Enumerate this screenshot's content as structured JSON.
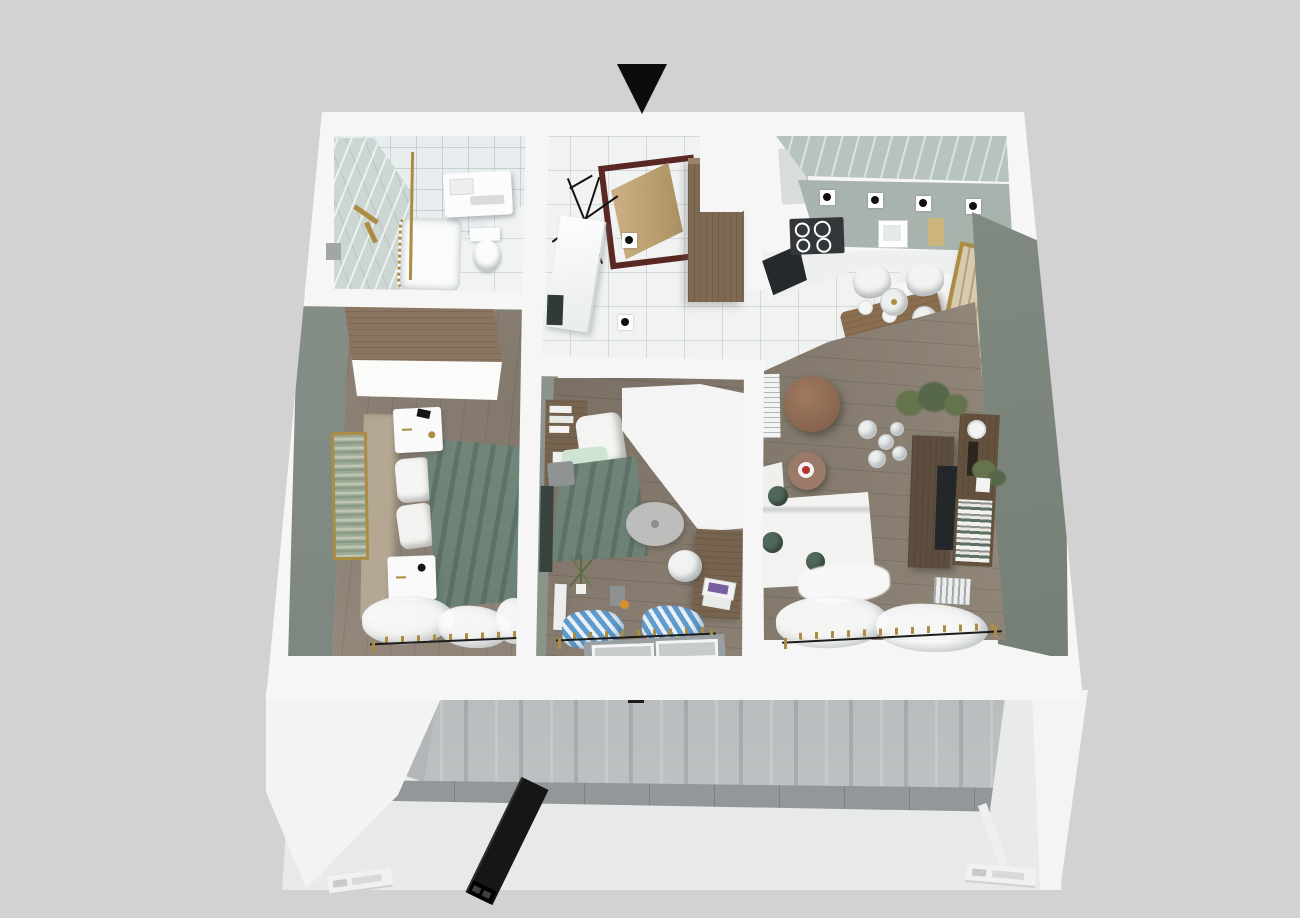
{
  "scene": {
    "kind": "3d-apartment-floorplan-render",
    "view": "top-down cutaway with building facade below",
    "width_px": 1300,
    "height_px": 918
  },
  "marker": {
    "shape": "triangle-down",
    "meaning": "entrance-direction-marker",
    "color": "#0c0c0c"
  },
  "colors": {
    "bg": "#d2d2d2",
    "wallWhite": "#f6f6f6",
    "wallShade": "#e2e4e4",
    "tileWhite": "#f1f3f3",
    "bathGrid": "#e8eeef",
    "marble": "#ccd6d3",
    "kitchenMarble": "#b7c4be",
    "cabinetSage": "#a9b3ad",
    "sage": "#8b948b",
    "sageDark": "#75807a",
    "greenWall": "#7d877d",
    "bed1Floor": "#9c9183",
    "bed2Floor": "#8d8174",
    "livingFloor": "#968c7e",
    "wardrobeWood": "#8b7560",
    "hallWood": "#7e6a53",
    "deskWood": "#77644f",
    "tvWood": "#5d4d3e",
    "tableWood": "#8a6e50",
    "doorWood": "#c3a878",
    "doorFrame": "#5a2823",
    "blanketGreen": "#5c7567",
    "cushionGreen": "#50685a",
    "plantGreen": "#66744d",
    "gold": "#ab8c42",
    "rodBlack": "#1c1c1c",
    "curtainBlue": "#5f9bcd",
    "rugBrown": "#9b7a6a",
    "rugGray": "#c2c4c3",
    "artBeige": "#d8caaf",
    "stoveDark": "#33373a",
    "tvDark": "#24272a",
    "concreteDark": "#9aa0a3",
    "concreteLight": "#c2c6c7",
    "facadeLight": "#e8e9e9",
    "ledgeGray": "#caced0",
    "accentOrange": "#d98f2e",
    "cakeRed": "#b5342c"
  },
  "apartment": {
    "rooms": [
      {
        "name": "bathroom",
        "position": "top-left",
        "furniture": [
          "marble-shower-wall",
          "gold-shower-fixture",
          "gold-shower-rail",
          "bathtub",
          "floating-washbasin",
          "toilet",
          "tiled-ceiling-grid"
        ]
      },
      {
        "name": "entry-hall",
        "position": "top-center",
        "furniture": [
          "entry-door-open",
          "dark-red-door-frame",
          "coat-rack",
          "leaning-mirror",
          "hall-wardrobe",
          "ceiling-spotlights",
          "white-tile-floor"
        ]
      },
      {
        "name": "kitchen-dining",
        "position": "top-right",
        "furniture": [
          "upper-cabinets-with-spotlights",
          "induction-stove",
          "oven",
          "sink",
          "counter",
          "fridge",
          "dining-table",
          "four-white-chairs",
          "pendant-lamps",
          "gold-framed-art"
        ]
      },
      {
        "name": "bedroom-primary",
        "position": "left",
        "furniture": [
          "wood-wardrobe",
          "double-bed",
          "green-blanket",
          "white-pillows",
          "nightstand-top",
          "nightstand-bottom",
          "tall-wall-art",
          "sheer-curtains",
          "curtain-rod-gold-rings"
        ]
      },
      {
        "name": "bedroom-second",
        "position": "center",
        "furniture": [
          "single-bed",
          "green-blanket",
          "headboard-shelf-books",
          "white-corner-wardrobe",
          "desk",
          "laptop",
          "desk-chair",
          "round-gray-rug",
          "gray-pouf",
          "wall-board",
          "plant",
          "floor-lamp",
          "blue-striped-curtains",
          "waste-bin",
          "orange-ball"
        ]
      },
      {
        "name": "living-room",
        "position": "right",
        "furniture": [
          "corner-sofa-white",
          "green-cushions",
          "round-wood-coffee-table",
          "side-table-with-cake",
          "pendant-globe-cluster",
          "tv-console",
          "tv",
          "bookshelf",
          "plants",
          "radiator",
          "air-conditioner",
          "sheer-curtains",
          "round-brown-rug"
        ]
      }
    ],
    "walls": "white perspective shell with interior partitions and bottom window wall"
  },
  "facade": {
    "description": "building story below apartment",
    "elements": [
      "concrete-wall-band",
      "vent-slot",
      "balcony-ledge-glass-row",
      "black-steel-beam",
      "white-left-wing",
      "white-right-column",
      "diagonal-white-beams",
      "aluminium-profiles-with-holes"
    ]
  }
}
